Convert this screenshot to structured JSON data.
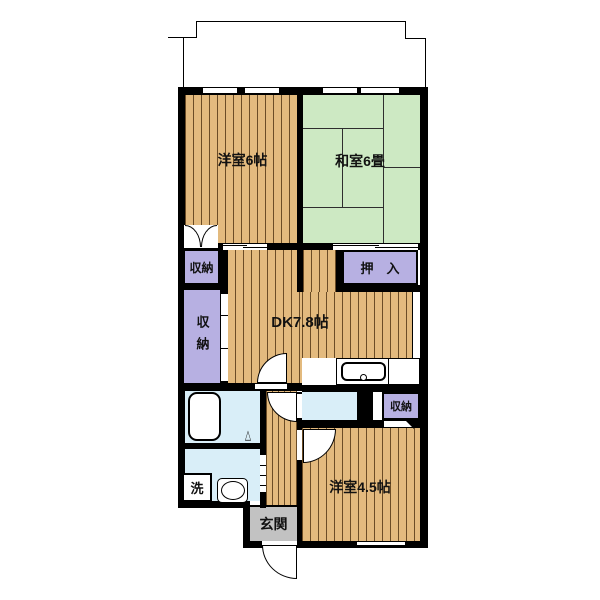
{
  "rooms": {
    "yoshitsu6": {
      "label": "洋室6帖",
      "size_jo": 6
    },
    "washitsu6": {
      "label": "和室6畳",
      "size_jo": 6
    },
    "dk": {
      "label": "DK7.8帖",
      "size_jo": 7.8
    },
    "yoshitsu45": {
      "label": "洋室4.5帖",
      "size_jo": 4.5
    },
    "oshiire": {
      "label": "押　入"
    },
    "closet_upper": {
      "label": "収納"
    },
    "closet_left": {
      "label": "収納"
    },
    "closet_east": {
      "label": "収納"
    },
    "genkan": {
      "label": "玄関"
    },
    "laundry": {
      "label": "洗"
    }
  },
  "palette": {
    "bg": "#ffffff",
    "wall": "#000000",
    "wood": "#e3ba7e",
    "wood_line": "#6b4c26",
    "tatami": "#cde9c3",
    "tatami_line": "#2e2e2e",
    "closet": "#b7b0e2",
    "water": "#d9eef8",
    "genkan": "#c2c2c2"
  }
}
